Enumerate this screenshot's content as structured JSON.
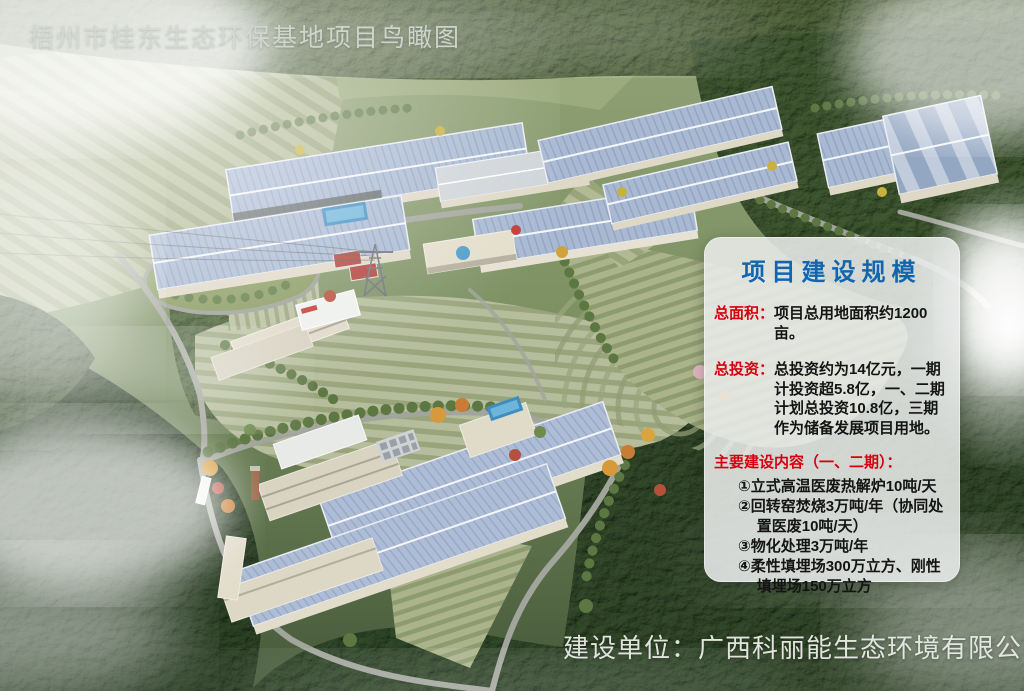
{
  "title": "梧州市桂东生态环保基地项目鸟瞰图",
  "panel": {
    "title": "项目建设规模",
    "area_label": "总面积：",
    "area_text": "项目总用地面积约1200亩。",
    "investment_label": "总投资：",
    "investment_text": "总投资约为14亿元，一期计投资超5.8亿，一、二期计划总投资10.8亿，三期作为储备发展项目用地。",
    "content_label": "主要建设内容（一、二期）：",
    "items": [
      "①立式高温医废热解炉10吨/天",
      "②回转窑焚烧3万吨/年（协同处置医废10吨/天）",
      "③物化处理3万吨/年",
      "④柔性填埋场300万立方、刚性填埋场150万立方"
    ]
  },
  "footer": {
    "label": "建设单位：广西科丽能生态环境有限公司"
  },
  "colors": {
    "panel_title_blue": "#1266b0",
    "label_red": "#d7000f",
    "body_text": "#141414",
    "scene_title_gray": "#d5dad4",
    "footer_white": "#e8ebe5",
    "roof_blue": "#a9b9d2",
    "forest_green": "#35492a"
  }
}
